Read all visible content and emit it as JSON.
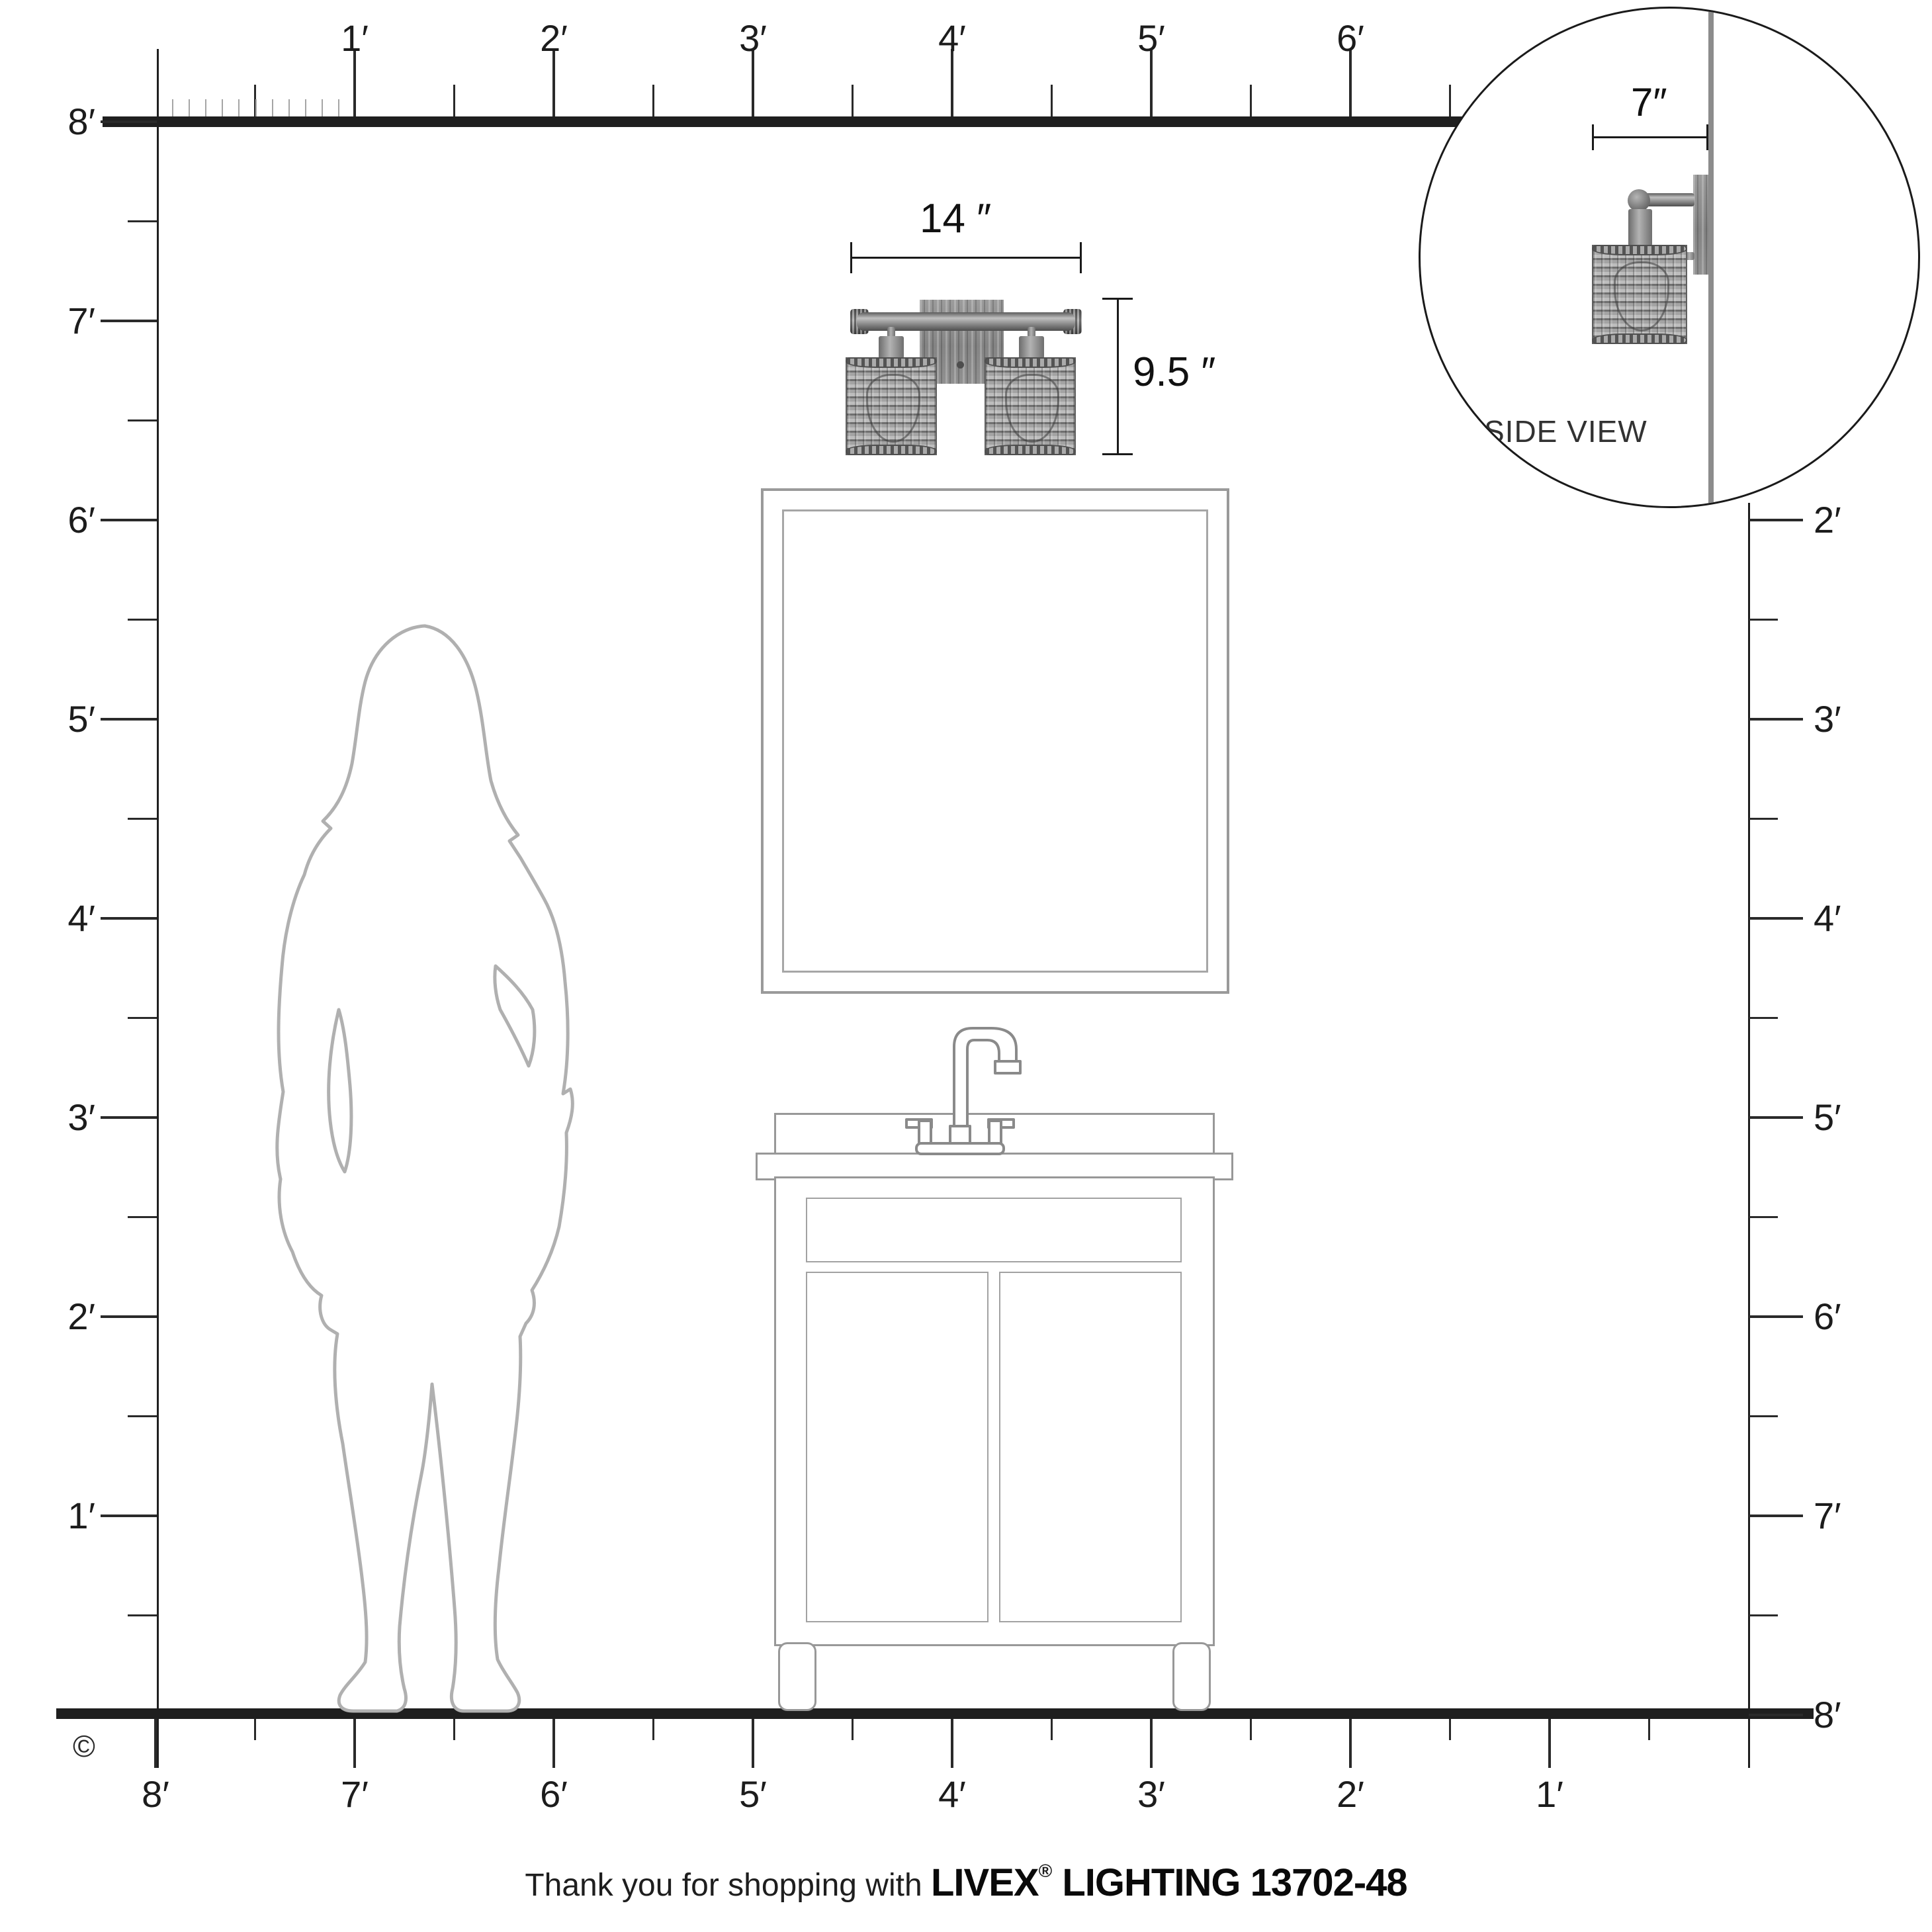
{
  "title": "Livex Lighting 13702-48 scale dimension diagram",
  "rulers": {
    "top_labels": [
      "1′",
      "2′",
      "3′",
      "4′",
      "5′",
      "6′"
    ],
    "left_labels": [
      "8′",
      "7′",
      "6′",
      "5′",
      "4′",
      "3′",
      "2′",
      "1′"
    ],
    "right_labels": [
      "2′",
      "3′",
      "4′",
      "5′",
      "6′",
      "7′",
      "8′"
    ],
    "bottom_labels": [
      "8′",
      "7′",
      "6′",
      "5′",
      "4′",
      "3′",
      "2′",
      "1′"
    ]
  },
  "dimensions": {
    "fixture_width": "14 ″",
    "fixture_height": "9.5 ″",
    "fixture_depth": "7″"
  },
  "side_view": {
    "label": "SIDE VIEW"
  },
  "copyright_symbol": "©",
  "footer": {
    "prefix": "Thank you for shopping with ",
    "brand": "LIVEX",
    "registered": "®",
    "suffix": " LIGHTING 13702-48"
  },
  "colors": {
    "line_black": "#1f1f1f",
    "outline_gray": "#9a9a9a",
    "silhouette_gray": "#b0b0b0",
    "wall_gray": "#8c8c8c",
    "fixture_gray": "#8f8f8f"
  }
}
